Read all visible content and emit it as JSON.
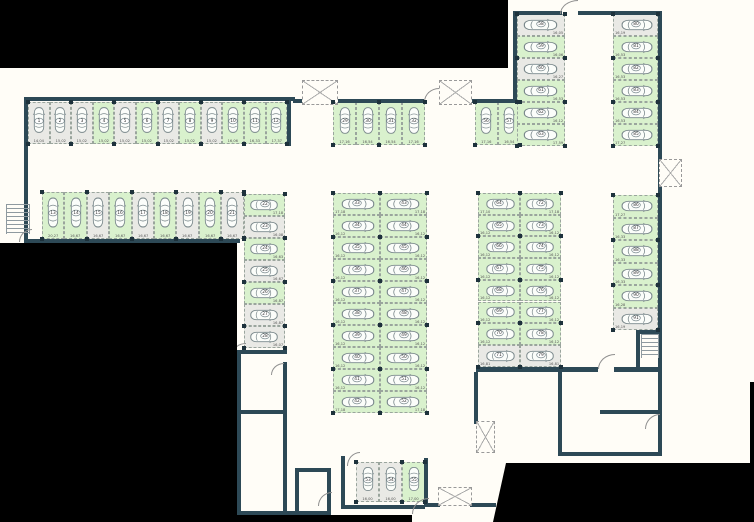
{
  "colors": {
    "available_fill": "#d9f1cd",
    "occupied_fill": "#e9e9e5",
    "wall": "#2d4956",
    "background": "#fffdf7",
    "masked_region": "#000000"
  },
  "sections": [
    {
      "id": "row-1-12",
      "spaces": [
        {
          "num": "1",
          "dim": "14,04",
          "status": "occupied"
        },
        {
          "num": "2",
          "dim": "15,02",
          "status": "occupied"
        },
        {
          "num": "3",
          "dim": "15,02",
          "status": "occupied"
        },
        {
          "num": "4",
          "dim": "15,02",
          "status": "available"
        },
        {
          "num": "5",
          "dim": "15,02",
          "status": "occupied"
        },
        {
          "num": "6",
          "dim": "15,02",
          "status": "available"
        },
        {
          "num": "7",
          "dim": "15,02",
          "status": "occupied"
        },
        {
          "num": "8",
          "dim": "15,02",
          "status": "available"
        },
        {
          "num": "9",
          "dim": "15,02",
          "status": "occupied"
        },
        {
          "num": "10",
          "dim": "16,06",
          "status": "available"
        },
        {
          "num": "11",
          "dim": "16,33",
          "status": "available"
        },
        {
          "num": "12",
          "dim": "17,37",
          "status": "available"
        }
      ]
    },
    {
      "id": "row-13-21",
      "spaces": [
        {
          "num": "13",
          "dim": "20,27",
          "status": "available"
        },
        {
          "num": "14",
          "dim": "16,67",
          "status": "available"
        },
        {
          "num": "15",
          "dim": "16,67",
          "status": "occupied"
        },
        {
          "num": "16",
          "dim": "16,67",
          "status": "available"
        },
        {
          "num": "17",
          "dim": "16,67",
          "status": "occupied"
        },
        {
          "num": "18",
          "dim": "16,67",
          "status": "available"
        },
        {
          "num": "19",
          "dim": "16,67",
          "status": "occupied"
        },
        {
          "num": "20",
          "dim": "16,67",
          "status": "available"
        },
        {
          "num": "21",
          "dim": "16,67",
          "status": "occupied"
        }
      ]
    },
    {
      "id": "col-22-28",
      "spaces": [
        {
          "num": "22",
          "dim": "17,18",
          "status": "available"
        },
        {
          "num": "23",
          "dim": "16,08",
          "status": "occupied"
        },
        {
          "num": "24",
          "dim": "16,63",
          "status": "available"
        },
        {
          "num": "25",
          "dim": "16,67",
          "status": "occupied"
        },
        {
          "num": "26",
          "dim": "16,87",
          "status": "available"
        },
        {
          "num": "27",
          "dim": "16,87",
          "status": "occupied"
        },
        {
          "num": "28",
          "dim": "16,07",
          "status": "occupied"
        }
      ]
    },
    {
      "id": "row-29-32",
      "spaces": [
        {
          "num": "29",
          "dim": "17,16",
          "status": "available"
        },
        {
          "num": "30",
          "dim": "16,54",
          "status": "available"
        },
        {
          "num": "31",
          "dim": "16,54",
          "status": "available"
        },
        {
          "num": "32",
          "dim": "17,16",
          "status": "available"
        }
      ]
    },
    {
      "id": "col-33-42",
      "spaces": [
        {
          "num": "33",
          "dim": "17,18",
          "status": "available"
        },
        {
          "num": "34",
          "dim": "16,12",
          "status": "available"
        },
        {
          "num": "35",
          "dim": "16,12",
          "status": "available"
        },
        {
          "num": "36",
          "dim": "16,12",
          "status": "available"
        },
        {
          "num": "37",
          "dim": "16,12",
          "status": "available"
        },
        {
          "num": "38",
          "dim": "16,12",
          "status": "available"
        },
        {
          "num": "39",
          "dim": "16,12",
          "status": "available"
        },
        {
          "num": "40",
          "dim": "16,12",
          "status": "available"
        },
        {
          "num": "41",
          "dim": "16,12",
          "status": "available"
        },
        {
          "num": "42",
          "dim": "17,18",
          "status": "available"
        }
      ]
    },
    {
      "id": "col-43-52",
      "spaces": [
        {
          "num": "43",
          "dim": "17,18",
          "status": "available"
        },
        {
          "num": "44",
          "dim": "16,12",
          "status": "available"
        },
        {
          "num": "45",
          "dim": "16,12",
          "status": "available"
        },
        {
          "num": "46",
          "dim": "16,12",
          "status": "available"
        },
        {
          "num": "47",
          "dim": "16,12",
          "status": "available"
        },
        {
          "num": "48",
          "dim": "16,12",
          "status": "available"
        },
        {
          "num": "49",
          "dim": "16,12",
          "status": "available"
        },
        {
          "num": "50",
          "dim": "16,12",
          "status": "available"
        },
        {
          "num": "51",
          "dim": "16,12",
          "status": "available"
        },
        {
          "num": "52",
          "dim": "17,18",
          "status": "available"
        }
      ]
    },
    {
      "id": "row-53-55",
      "spaces": [
        {
          "num": "53",
          "dim": "16,00",
          "status": "occupied"
        },
        {
          "num": "54",
          "dim": "16,00",
          "status": "occupied"
        },
        {
          "num": "55",
          "dim": "17,00",
          "status": "available"
        }
      ]
    },
    {
      "id": "row-56-57",
      "spaces": [
        {
          "num": "56",
          "dim": "17,16",
          "status": "available"
        },
        {
          "num": "57",
          "dim": "16,54",
          "status": "available"
        }
      ]
    },
    {
      "id": "col-58-63",
      "spaces": [
        {
          "num": "58",
          "dim": "16,05",
          "status": "occupied"
        },
        {
          "num": "59",
          "dim": "16,06",
          "status": "available"
        },
        {
          "num": "60",
          "dim": "16,27",
          "status": "occupied"
        },
        {
          "num": "61",
          "dim": "16,53",
          "status": "available"
        },
        {
          "num": "62",
          "dim": "16,12",
          "status": "available"
        },
        {
          "num": "63",
          "dim": "17,59",
          "status": "available"
        }
      ]
    },
    {
      "id": "col-64-71",
      "spaces": [
        {
          "num": "64",
          "dim": "17,10",
          "status": "available"
        },
        {
          "num": "65",
          "dim": "16,12",
          "status": "available"
        },
        {
          "num": "66",
          "dim": "16,12",
          "status": "available"
        },
        {
          "num": "67",
          "dim": "16,12",
          "status": "available"
        },
        {
          "num": "68",
          "dim": "16,12",
          "status": "available"
        },
        {
          "num": "69",
          "dim": "16,12",
          "status": "available"
        },
        {
          "num": "70",
          "dim": "16,12",
          "status": "available"
        },
        {
          "num": "71",
          "dim": "16,81",
          "status": "occupied"
        }
      ]
    },
    {
      "id": "col-72-79",
      "spaces": [
        {
          "num": "72",
          "dim": "17,18",
          "status": "available"
        },
        {
          "num": "73",
          "dim": "16,12",
          "status": "available"
        },
        {
          "num": "74",
          "dim": "16,12",
          "status": "available"
        },
        {
          "num": "75",
          "dim": "16,12",
          "status": "available"
        },
        {
          "num": "76",
          "dim": "16,12",
          "status": "available"
        },
        {
          "num": "77",
          "dim": "16,12",
          "status": "available"
        },
        {
          "num": "78",
          "dim": "16,12",
          "status": "available"
        },
        {
          "num": "79",
          "dim": "16,81",
          "status": "occupied"
        }
      ]
    },
    {
      "id": "col-80-85",
      "spaces": [
        {
          "num": "80",
          "dim": "16,19",
          "status": "occupied"
        },
        {
          "num": "81",
          "dim": "16,53",
          "status": "available"
        },
        {
          "num": "82",
          "dim": "16,53",
          "status": "available"
        },
        {
          "num": "83",
          "dim": "16,53",
          "status": "available"
        },
        {
          "num": "84",
          "dim": "16,53",
          "status": "available"
        },
        {
          "num": "85",
          "dim": "17,27",
          "status": "available"
        }
      ]
    },
    {
      "id": "col-86-91",
      "spaces": [
        {
          "num": "86",
          "dim": "17,27",
          "status": "available"
        },
        {
          "num": "87",
          "dim": "16,33",
          "status": "available"
        },
        {
          "num": "88",
          "dim": "16,33",
          "status": "available"
        },
        {
          "num": "89",
          "dim": "16,33",
          "status": "available"
        },
        {
          "num": "90",
          "dim": "16,28",
          "status": "available"
        },
        {
          "num": "91",
          "dim": "16,19",
          "status": "occupied"
        }
      ]
    }
  ]
}
